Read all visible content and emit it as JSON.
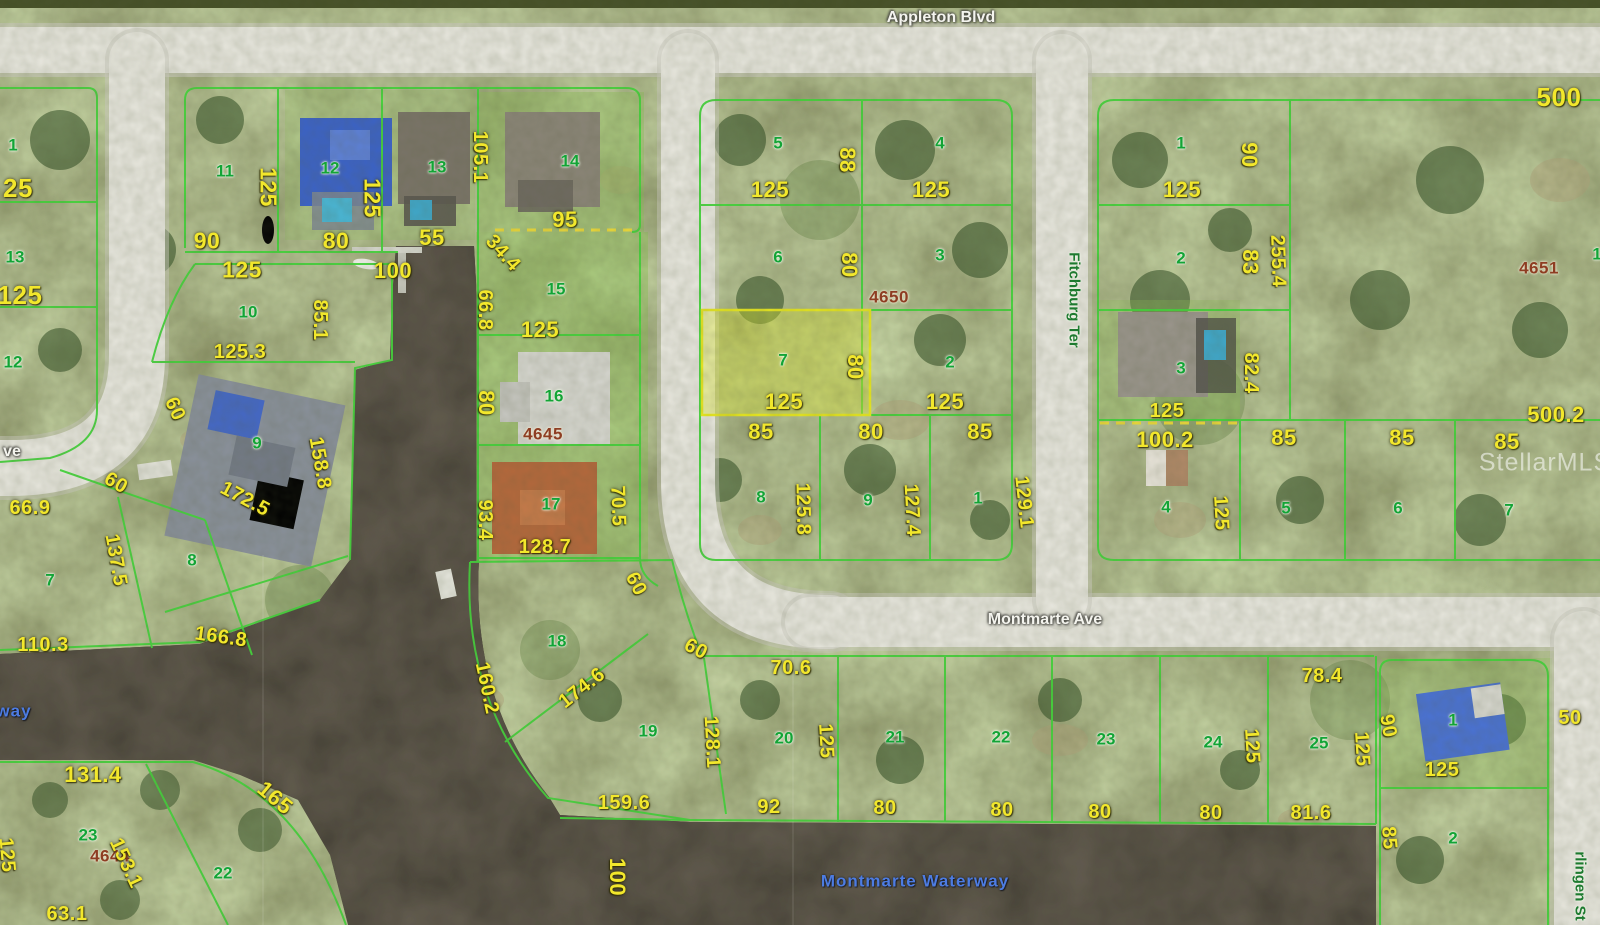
{
  "map": {
    "title": "Aerial parcel map with lot dimensions",
    "streets": {
      "top": "Appleton Blvd",
      "middle": "Montmarte Ave",
      "vertical_right_of_center": "Fitchburg Ter",
      "bottom_right_partial": "rlingen St",
      "left_partial": "ve"
    },
    "waterway": "Montmarte Waterway",
    "watermark": "StellarMLS",
    "block_numbers": [
      "4650",
      "4651",
      "4645",
      "4644"
    ],
    "highlighted_lot": {
      "lot": "7",
      "block": "4650",
      "width": "125",
      "depth": "80"
    },
    "labels": [
      {
        "t": "Appleton Blvd",
        "x": 941,
        "y": 18,
        "c": "street",
        "n": "street-label-appleton-blvd"
      },
      {
        "t": "Montmarte Ave",
        "x": 1045,
        "y": 620,
        "c": "street",
        "n": "street-label-montmarte-ave"
      },
      {
        "t": "ve",
        "x": 12,
        "y": 452,
        "c": "street",
        "n": "street-label-partial-ave"
      },
      {
        "t": "Fitchburg Ter",
        "x": 1074,
        "y": 300,
        "r": 90,
        "c": "streetg",
        "n": "street-label-fitchburg-ter"
      },
      {
        "t": "rlingen St",
        "x": 1580,
        "y": 886,
        "r": 90,
        "c": "streetg",
        "n": "street-label-harlingen-st"
      },
      {
        "t": "Montmarte Waterway",
        "x": 915,
        "y": 881,
        "c": "water",
        "n": "waterway-label"
      },
      {
        "t": "way",
        "x": 14,
        "y": 711,
        "c": "water",
        "n": "waterway-label-partial"
      },
      {
        "t": "StellarMLS",
        "x": 1545,
        "y": 463,
        "c": "wm",
        "n": "stellar-mls-watermark"
      },
      {
        "t": "4650",
        "x": 889,
        "y": 297,
        "c": "blk"
      },
      {
        "t": "4651",
        "x": 1539,
        "y": 268,
        "c": "blk"
      },
      {
        "t": "4645",
        "x": 543,
        "y": 434,
        "c": "blk"
      },
      {
        "t": "4644",
        "x": 110,
        "y": 856,
        "c": "blk"
      },
      {
        "t": "1",
        "x": 13,
        "y": 145,
        "c": "lot"
      },
      {
        "t": "13",
        "x": 15,
        "y": 257,
        "c": "lot"
      },
      {
        "t": "12",
        "x": 13,
        "y": 362,
        "c": "lot"
      },
      {
        "t": "11",
        "x": 225,
        "y": 171,
        "c": "lot"
      },
      {
        "t": "12",
        "x": 330,
        "y": 168,
        "c": "lot"
      },
      {
        "t": "13",
        "x": 437,
        "y": 167,
        "c": "lot"
      },
      {
        "t": "14",
        "x": 570,
        "y": 161,
        "c": "lot"
      },
      {
        "t": "15",
        "x": 556,
        "y": 289,
        "c": "lot"
      },
      {
        "t": "16",
        "x": 554,
        "y": 396,
        "c": "lot"
      },
      {
        "t": "17",
        "x": 551,
        "y": 504,
        "c": "lot"
      },
      {
        "t": "10",
        "x": 248,
        "y": 312,
        "c": "lot"
      },
      {
        "t": "9",
        "x": 257,
        "y": 443,
        "c": "lot"
      },
      {
        "t": "7",
        "x": 50,
        "y": 580,
        "c": "lot"
      },
      {
        "t": "8",
        "x": 192,
        "y": 560,
        "c": "lot"
      },
      {
        "t": "5",
        "x": 778,
        "y": 143,
        "c": "lot"
      },
      {
        "t": "4",
        "x": 940,
        "y": 143,
        "c": "lot"
      },
      {
        "t": "6",
        "x": 778,
        "y": 257,
        "c": "lot"
      },
      {
        "t": "3",
        "x": 940,
        "y": 255,
        "c": "lot"
      },
      {
        "t": "7",
        "x": 783,
        "y": 360,
        "c": "lot"
      },
      {
        "t": "2",
        "x": 950,
        "y": 362,
        "c": "lot"
      },
      {
        "t": "8",
        "x": 761,
        "y": 497,
        "c": "lot"
      },
      {
        "t": "9",
        "x": 868,
        "y": 500,
        "c": "lot"
      },
      {
        "t": "1",
        "x": 978,
        "y": 498,
        "c": "lot"
      },
      {
        "t": "1",
        "x": 1181,
        "y": 143,
        "c": "lot"
      },
      {
        "t": "2",
        "x": 1181,
        "y": 258,
        "c": "lot"
      },
      {
        "t": "3",
        "x": 1181,
        "y": 368,
        "c": "lot"
      },
      {
        "t": "4",
        "x": 1166,
        "y": 507,
        "c": "lot"
      },
      {
        "t": "5",
        "x": 1286,
        "y": 508,
        "c": "lot"
      },
      {
        "t": "6",
        "x": 1398,
        "y": 508,
        "c": "lot"
      },
      {
        "t": "7",
        "x": 1509,
        "y": 510,
        "c": "lot"
      },
      {
        "t": "1",
        "x": 1597,
        "y": 254,
        "c": "lot"
      },
      {
        "t": "18",
        "x": 557,
        "y": 641,
        "c": "lot"
      },
      {
        "t": "19",
        "x": 648,
        "y": 731,
        "c": "lot"
      },
      {
        "t": "20",
        "x": 784,
        "y": 738,
        "c": "lot"
      },
      {
        "t": "21",
        "x": 895,
        "y": 737,
        "c": "lot"
      },
      {
        "t": "22",
        "x": 1001,
        "y": 737,
        "c": "lot"
      },
      {
        "t": "23",
        "x": 1106,
        "y": 739,
        "c": "lot"
      },
      {
        "t": "24",
        "x": 1213,
        "y": 742,
        "c": "lot"
      },
      {
        "t": "25",
        "x": 1319,
        "y": 743,
        "c": "lot"
      },
      {
        "t": "23",
        "x": 88,
        "y": 835,
        "c": "lot"
      },
      {
        "t": "22",
        "x": 223,
        "y": 873,
        "c": "lot"
      },
      {
        "t": "1",
        "x": 1453,
        "y": 720,
        "c": "lot"
      },
      {
        "t": "2",
        "x": 1453,
        "y": 838,
        "c": "lot"
      },
      {
        "t": "25",
        "x": 18,
        "y": 188,
        "c": "dim",
        "s": 26
      },
      {
        "t": "125",
        "x": 20,
        "y": 295,
        "c": "dim",
        "s": 26
      },
      {
        "t": "125",
        "x": 268,
        "y": 187,
        "r": 90,
        "c": "dim",
        "s": 23
      },
      {
        "t": "90",
        "x": 207,
        "y": 241,
        "c": "dim",
        "s": 23
      },
      {
        "t": "125",
        "x": 242,
        "y": 270,
        "c": "dim",
        "s": 23
      },
      {
        "t": "80",
        "x": 336,
        "y": 241,
        "c": "dim",
        "s": 23
      },
      {
        "t": "125",
        "x": 372,
        "y": 198,
        "r": 90,
        "c": "dim",
        "s": 23
      },
      {
        "t": "105.1",
        "x": 480,
        "y": 157,
        "r": 90,
        "c": "dim"
      },
      {
        "t": "55",
        "x": 432,
        "y": 238,
        "c": "dim",
        "s": 22
      },
      {
        "t": "34.4",
        "x": 503,
        "y": 253,
        "r": 48,
        "c": "dim"
      },
      {
        "t": "100",
        "x": 393,
        "y": 271,
        "c": "dim",
        "s": 22
      },
      {
        "t": "95",
        "x": 565,
        "y": 220,
        "c": "dim",
        "s": 22
      },
      {
        "t": "66.8",
        "x": 485,
        "y": 310,
        "r": 90,
        "c": "dim"
      },
      {
        "t": "125",
        "x": 540,
        "y": 330,
        "c": "dim",
        "s": 22
      },
      {
        "t": "80",
        "x": 486,
        "y": 403,
        "r": 90,
        "c": "dim",
        "s": 22
      },
      {
        "t": "93.4",
        "x": 485,
        "y": 520,
        "r": 90,
        "c": "dim"
      },
      {
        "t": "70.5",
        "x": 618,
        "y": 506,
        "r": 88,
        "c": "dim"
      },
      {
        "t": "128.7",
        "x": 545,
        "y": 547,
        "c": "dim"
      },
      {
        "t": "85.1",
        "x": 320,
        "y": 320,
        "r": 90,
        "c": "dim"
      },
      {
        "t": "125.3",
        "x": 240,
        "y": 352,
        "c": "dim"
      },
      {
        "t": "158.8",
        "x": 320,
        "y": 463,
        "r": 80,
        "c": "dim"
      },
      {
        "t": "172.5",
        "x": 245,
        "y": 499,
        "r": 28,
        "c": "dim"
      },
      {
        "t": "60",
        "x": 175,
        "y": 409,
        "r": 65,
        "c": "dim"
      },
      {
        "t": "60",
        "x": 116,
        "y": 483,
        "r": 30,
        "c": "dim"
      },
      {
        "t": "66.9",
        "x": 30,
        "y": 508,
        "c": "dim"
      },
      {
        "t": "137.5",
        "x": 116,
        "y": 560,
        "r": 80,
        "c": "dim"
      },
      {
        "t": "110.3",
        "x": 43,
        "y": 645,
        "c": "dim"
      },
      {
        "t": "166.8",
        "x": 221,
        "y": 637,
        "r": 8,
        "c": "dim"
      },
      {
        "t": "88",
        "x": 847,
        "y": 160,
        "r": 90,
        "c": "dim",
        "s": 22
      },
      {
        "t": "125",
        "x": 770,
        "y": 190,
        "c": "dim",
        "s": 22
      },
      {
        "t": "125",
        "x": 931,
        "y": 190,
        "c": "dim",
        "s": 22
      },
      {
        "t": "80",
        "x": 849,
        "y": 265,
        "r": 90,
        "c": "dim",
        "s": 22
      },
      {
        "t": "80",
        "x": 855,
        "y": 367,
        "r": 90,
        "c": "dim",
        "s": 22
      },
      {
        "t": "125",
        "x": 784,
        "y": 402,
        "c": "dim",
        "s": 22
      },
      {
        "t": "125",
        "x": 945,
        "y": 402,
        "c": "dim",
        "s": 22
      },
      {
        "t": "85",
        "x": 761,
        "y": 432,
        "c": "dim",
        "s": 22
      },
      {
        "t": "80",
        "x": 871,
        "y": 432,
        "c": "dim",
        "s": 22
      },
      {
        "t": "85",
        "x": 980,
        "y": 432,
        "c": "dim",
        "s": 22
      },
      {
        "t": "125.8",
        "x": 803,
        "y": 509,
        "r": 89,
        "c": "dim"
      },
      {
        "t": "127.4",
        "x": 912,
        "y": 510,
        "r": 87,
        "c": "dim"
      },
      {
        "t": "129.1",
        "x": 1024,
        "y": 502,
        "r": 84,
        "c": "dim"
      },
      {
        "t": "90",
        "x": 1249,
        "y": 155,
        "r": 90,
        "c": "dim",
        "s": 22
      },
      {
        "t": "125",
        "x": 1182,
        "y": 190,
        "c": "dim",
        "s": 22
      },
      {
        "t": "500",
        "x": 1559,
        "y": 97,
        "c": "dim",
        "s": 26
      },
      {
        "t": "83",
        "x": 1250,
        "y": 262,
        "r": 90,
        "c": "dim",
        "s": 22
      },
      {
        "t": "255.4",
        "x": 1278,
        "y": 261,
        "r": 88,
        "c": "dim"
      },
      {
        "t": "82.4",
        "x": 1251,
        "y": 373,
        "r": 90,
        "c": "dim"
      },
      {
        "t": "125",
        "x": 1167,
        "y": 411,
        "c": "dim"
      },
      {
        "t": "500.2",
        "x": 1556,
        "y": 415,
        "c": "dim",
        "s": 22
      },
      {
        "t": "100.2",
        "x": 1165,
        "y": 440,
        "c": "dim",
        "s": 22
      },
      {
        "t": "85",
        "x": 1284,
        "y": 438,
        "c": "dim",
        "s": 22
      },
      {
        "t": "85",
        "x": 1402,
        "y": 438,
        "c": "dim",
        "s": 22
      },
      {
        "t": "85",
        "x": 1507,
        "y": 442,
        "c": "dim",
        "s": 22
      },
      {
        "t": "125",
        "x": 1221,
        "y": 513,
        "r": 87,
        "c": "dim"
      },
      {
        "t": "60",
        "x": 636,
        "y": 584,
        "r": 62,
        "c": "dim"
      },
      {
        "t": "60",
        "x": 696,
        "y": 649,
        "r": 28,
        "c": "dim"
      },
      {
        "t": "160.2",
        "x": 487,
        "y": 688,
        "r": 78,
        "c": "dim"
      },
      {
        "t": "174.6",
        "x": 582,
        "y": 688,
        "r": -38,
        "c": "dim"
      },
      {
        "t": "128.1",
        "x": 712,
        "y": 742,
        "r": 87,
        "c": "dim"
      },
      {
        "t": "70.6",
        "x": 791,
        "y": 668,
        "c": "dim"
      },
      {
        "t": "125",
        "x": 826,
        "y": 741,
        "r": 87,
        "c": "dim"
      },
      {
        "t": "159.6",
        "x": 624,
        "y": 803,
        "c": "dim"
      },
      {
        "t": "92",
        "x": 769,
        "y": 807,
        "c": "dim"
      },
      {
        "t": "80",
        "x": 885,
        "y": 808,
        "c": "dim"
      },
      {
        "t": "80",
        "x": 1002,
        "y": 810,
        "c": "dim"
      },
      {
        "t": "80",
        "x": 1100,
        "y": 812,
        "c": "dim"
      },
      {
        "t": "80",
        "x": 1211,
        "y": 813,
        "c": "dim"
      },
      {
        "t": "81.6",
        "x": 1311,
        "y": 813,
        "c": "dim"
      },
      {
        "t": "78.4",
        "x": 1322,
        "y": 676,
        "c": "dim"
      },
      {
        "t": "125",
        "x": 1252,
        "y": 746,
        "r": 87,
        "c": "dim"
      },
      {
        "t": "125",
        "x": 1362,
        "y": 749,
        "r": 87,
        "c": "dim"
      },
      {
        "t": "90",
        "x": 1388,
        "y": 726,
        "r": 80,
        "c": "dim"
      },
      {
        "t": "50",
        "x": 1570,
        "y": 718,
        "c": "dim"
      },
      {
        "t": "125",
        "x": 1442,
        "y": 770,
        "c": "dim"
      },
      {
        "t": "85",
        "x": 1389,
        "y": 838,
        "r": 85,
        "c": "dim"
      },
      {
        "t": "100",
        "x": 617,
        "y": 877,
        "r": 90,
        "c": "dim",
        "s": 22
      },
      {
        "t": "131.4",
        "x": 93,
        "y": 775,
        "c": "dim",
        "s": 22
      },
      {
        "t": "165",
        "x": 275,
        "y": 798,
        "r": 40,
        "c": "dim",
        "s": 22
      },
      {
        "t": "153.1",
        "x": 126,
        "y": 863,
        "r": 65,
        "c": "dim"
      },
      {
        "t": "63.1",
        "x": 67,
        "y": 914,
        "c": "dim"
      },
      {
        "t": "125",
        "x": 7,
        "y": 855,
        "r": 85,
        "c": "dim"
      }
    ]
  }
}
